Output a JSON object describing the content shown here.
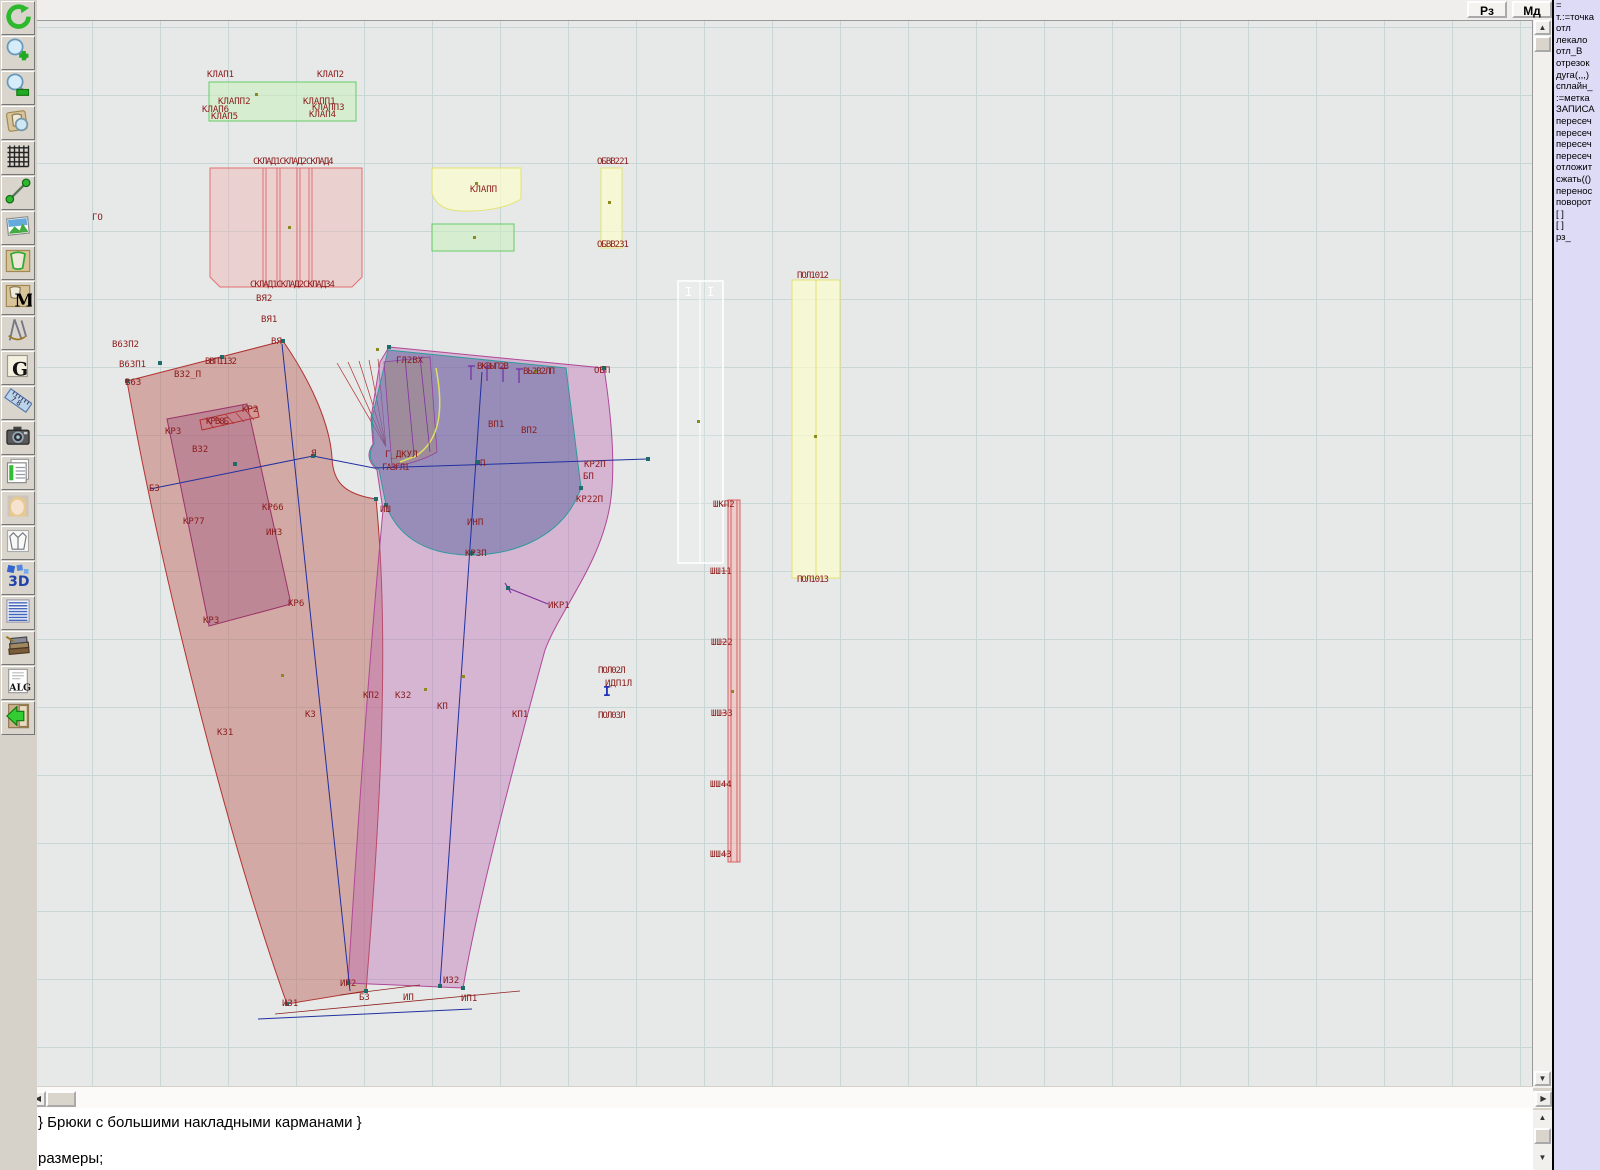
{
  "topbar": {
    "rz_label": "Рз",
    "md_label": "Мд"
  },
  "toolbar": {
    "icons": [
      "refresh",
      "zoom-in",
      "zoom-out",
      "inspect-piece",
      "grid",
      "measure",
      "image",
      "piece",
      "materials-m",
      "compass",
      "g-doc",
      "ruler",
      "camera",
      "table",
      "portrait",
      "garment",
      "3d",
      "list",
      "books",
      "alg",
      "exit"
    ]
  },
  "right_panel": {
    "lines": [
      "=",
      "т.:=точка",
      "отл",
      "лекало",
      "отл_В",
      "отрезок",
      "дуга(,,,)",
      "сплайн_",
      ":=метка",
      "ЗАПИСА",
      "пересеч",
      "пересеч",
      "пересеч",
      "пересеч",
      "отложит",
      "сжать(()",
      "перенос",
      "поворот",
      "[ ]",
      "[ ]",
      "рз_"
    ]
  },
  "editor": {
    "line1": "} Брюки с большими накладными карманами }",
    "line2": "размеры;"
  },
  "colors": {
    "label_red": "#8b1b1b",
    "back_piece_stroke": "#b23232",
    "front_piece_stroke": "#b04898",
    "pocket_teal": "#2d9b9b",
    "navy_line": "#2030a0",
    "yellow_stroke": "#e3e370",
    "green_stroke": "#66cc66",
    "pink_stroke": "#e47070",
    "panel_bg": "#dddbf6"
  },
  "canvas": {
    "labels": [
      {
        "t": "КЛАП1",
        "x": 207,
        "y": 77
      },
      {
        "t": "КЛАП2",
        "x": 317,
        "y": 77
      },
      {
        "t": "КЛАПП2",
        "x": 218,
        "y": 104
      },
      {
        "t": "КЛАПП1",
        "x": 303,
        "y": 104
      },
      {
        "t": "КЛАП6",
        "x": 202,
        "y": 112
      },
      {
        "t": "КЛАП5",
        "x": 211,
        "y": 119
      },
      {
        "t": "КЛАПП3",
        "x": 312,
        "y": 110
      },
      {
        "t": "КЛАП4",
        "x": 309,
        "y": 117
      },
      {
        "t": "СКЛАД1СКЛАД2СКЛАД4",
        "x": 253,
        "y": 164,
        "c": "sq"
      },
      {
        "t": "СКЛАД1СКЛАД2СКЛАД34",
        "x": 250,
        "y": 287,
        "c": "sq"
      },
      {
        "t": "КЛАПП",
        "x": 470,
        "y": 192
      },
      {
        "t": "ОБВВ221",
        "x": 597,
        "y": 164,
        "c": "sq"
      },
      {
        "t": "ОБВВ231",
        "x": 597,
        "y": 247,
        "c": "sq"
      },
      {
        "t": "ПОЛ1012",
        "x": 797,
        "y": 278,
        "c": "sq"
      },
      {
        "t": "ПОЛ1013",
        "x": 797,
        "y": 582,
        "c": "sq"
      },
      {
        "t": "ГО",
        "x": 92,
        "y": 220
      },
      {
        "t": "В63П2",
        "x": 112,
        "y": 347
      },
      {
        "t": "В63П1",
        "x": 119,
        "y": 367
      },
      {
        "t": "В63",
        "x": 125,
        "y": 385
      },
      {
        "t": "В32_П",
        "x": 174,
        "y": 377
      },
      {
        "t": "ВВП1132",
        "x": 205,
        "y": 364,
        "c": "sq"
      },
      {
        "t": "ВЯ2",
        "x": 256,
        "y": 301
      },
      {
        "t": "ВЯ1",
        "x": 261,
        "y": 322
      },
      {
        "t": "ВЯ",
        "x": 271,
        "y": 344
      },
      {
        "t": "КР2",
        "x": 242,
        "y": 412
      },
      {
        "t": "КРВ8Б",
        "x": 206,
        "y": 424,
        "c": "sq"
      },
      {
        "t": "КР3",
        "x": 165,
        "y": 434
      },
      {
        "t": "В32",
        "x": 192,
        "y": 452
      },
      {
        "t": "Б3",
        "x": 149,
        "y": 491
      },
      {
        "t": "Я",
        "x": 311,
        "y": 456
      },
      {
        "t": "КР66",
        "x": 262,
        "y": 510
      },
      {
        "t": "КР77",
        "x": 183,
        "y": 524
      },
      {
        "t": "ИН3",
        "x": 266,
        "y": 535
      },
      {
        "t": "КР6",
        "x": 288,
        "y": 606
      },
      {
        "t": "КР3",
        "x": 203,
        "y": 623
      },
      {
        "t": "К31",
        "x": 217,
        "y": 735
      },
      {
        "t": "К3",
        "x": 305,
        "y": 717
      },
      {
        "t": "КП2",
        "x": 363,
        "y": 698
      },
      {
        "t": "К32",
        "x": 395,
        "y": 698
      },
      {
        "t": "КП",
        "x": 437,
        "y": 709
      },
      {
        "t": "КП1",
        "x": 512,
        "y": 717
      },
      {
        "t": "ИШ",
        "x": 380,
        "y": 512
      },
      {
        "t": "ГЛ2ВХ",
        "x": 396,
        "y": 363
      },
      {
        "t": "ВКВЫП2В",
        "x": 477,
        "y": 369,
        "c": "sq"
      },
      {
        "t": "ВЬ2В2ЛП",
        "x": 523,
        "y": 374,
        "c": "sq"
      },
      {
        "t": "ОБП",
        "x": 594,
        "y": 373
      },
      {
        "t": "ВП1",
        "x": 488,
        "y": 427
      },
      {
        "t": "ВП2",
        "x": 521,
        "y": 433
      },
      {
        "t": "Г_ДКУЛ",
        "x": 385,
        "y": 457
      },
      {
        "t": "ГА3ГЛ1",
        "x": 382,
        "y": 470,
        "c": "sq"
      },
      {
        "t": "П",
        "x": 480,
        "y": 466
      },
      {
        "t": "КР2П",
        "x": 584,
        "y": 467
      },
      {
        "t": "БП",
        "x": 583,
        "y": 479
      },
      {
        "t": "КР22П",
        "x": 576,
        "y": 502
      },
      {
        "t": "ИНП",
        "x": 467,
        "y": 525
      },
      {
        "t": "КР3П",
        "x": 465,
        "y": 556
      },
      {
        "t": "ИКР1",
        "x": 548,
        "y": 608
      },
      {
        "t": "И31",
        "x": 282,
        "y": 1006
      },
      {
        "t": "ИП2",
        "x": 340,
        "y": 986
      },
      {
        "t": "Б3",
        "x": 359,
        "y": 1000
      },
      {
        "t": "ИП",
        "x": 403,
        "y": 1000
      },
      {
        "t": "И32",
        "x": 443,
        "y": 983
      },
      {
        "t": "ИП1",
        "x": 461,
        "y": 1001
      },
      {
        "t": "ШКП2",
        "x": 713,
        "y": 507
      },
      {
        "t": "ШШ11",
        "x": 710,
        "y": 574
      },
      {
        "t": "ШШ22",
        "x": 711,
        "y": 645
      },
      {
        "t": "ШШ33",
        "x": 711,
        "y": 716
      },
      {
        "t": "ШШ44",
        "x": 710,
        "y": 787
      },
      {
        "t": "ШШ43",
        "x": 710,
        "y": 857
      },
      {
        "t": "ПОЛ02Л",
        "x": 598,
        "y": 673,
        "c": "sq"
      },
      {
        "t": "ИДП1Л",
        "x": 605,
        "y": 686
      },
      {
        "t": "ПОЛ03Л",
        "x": 598,
        "y": 718,
        "c": "sq"
      },
      {
        "t": "I",
        "x": 685,
        "y": 296,
        "c": "wt"
      },
      {
        "t": "I",
        "x": 707,
        "y": 296,
        "c": "wt"
      },
      {
        "t": "I",
        "x": 603,
        "y": 696,
        "c": "cur"
      }
    ]
  }
}
